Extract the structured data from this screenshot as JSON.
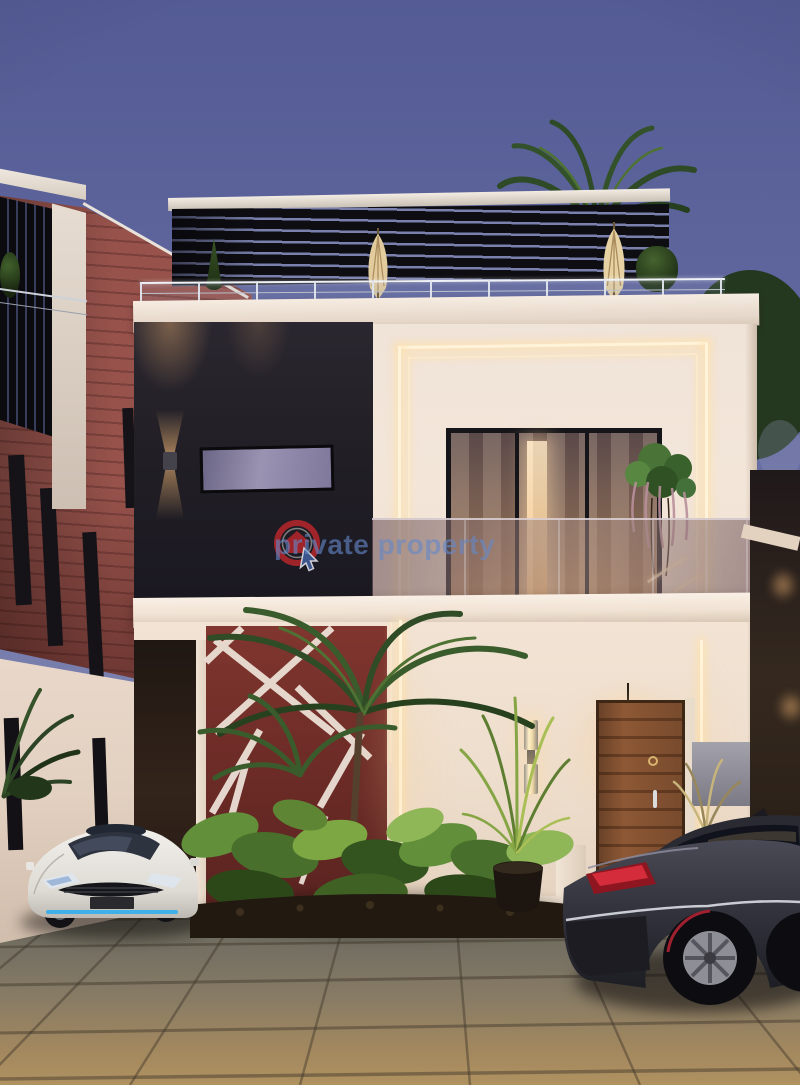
{
  "image": {
    "alt": "Dusk 3D architectural rendering of a modern white duplex with a rooftop pergola terrace, glass balcony, dark charcoal and red accent walls, tropical plants, a white hatchback and a dark sedan parked on a tiled driveway"
  },
  "watermark": {
    "brand_text": "private property",
    "logo_name": "privateproperty-house-cursor-logo",
    "text_color_rgba": "rgba(100,135,200,0.62)",
    "logo_ring_red": "#b2262c",
    "logo_cursor_blue": "#3f5f9c"
  },
  "palette": {
    "sky_top": "#545b95",
    "sky_horizon": "#b3b5cd",
    "wall_cream": "#f0e3d8",
    "wall_charcoal": "#221f26",
    "accent_red_wall": "#6e2c27",
    "red_siding": "#96524b",
    "pergola_black": "#0d0d12",
    "led_warm_white": "#fff3da",
    "wood_door": "#8d5835",
    "pavement_tan": "#a1875f",
    "foliage_green": "#3d5c2d"
  }
}
